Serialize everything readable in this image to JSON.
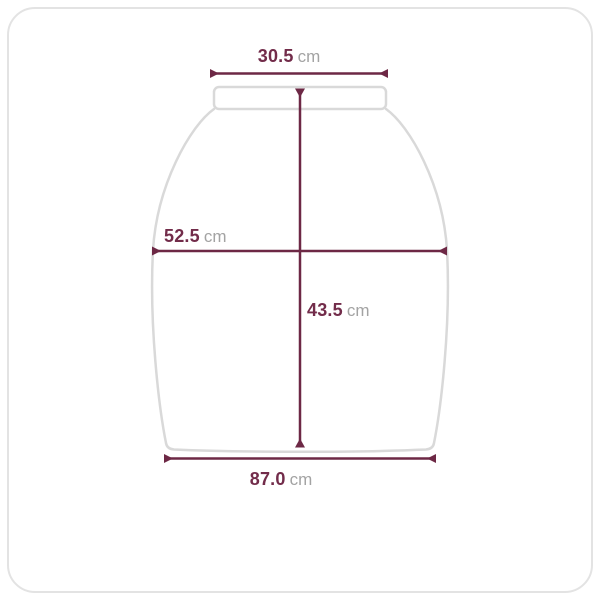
{
  "diagram": {
    "title": "garment-size-diagram",
    "shape": "skirt-outline-with-waistband"
  },
  "measurements": {
    "top_width": {
      "value": "30.5",
      "unit": "cm"
    },
    "side_width": {
      "value": "52.5",
      "unit": "cm"
    },
    "length": {
      "value": "43.5",
      "unit": "cm"
    },
    "hem_width": {
      "value": "87.0",
      "unit": "cm"
    }
  },
  "colors": {
    "dimension_line": "#6d2845",
    "value_text": "#722c4a",
    "unit_text": "#a3a3a3",
    "garment_outline": "#d9d9d9",
    "card_border": "#e3e3e3",
    "background": "#ffffff"
  }
}
